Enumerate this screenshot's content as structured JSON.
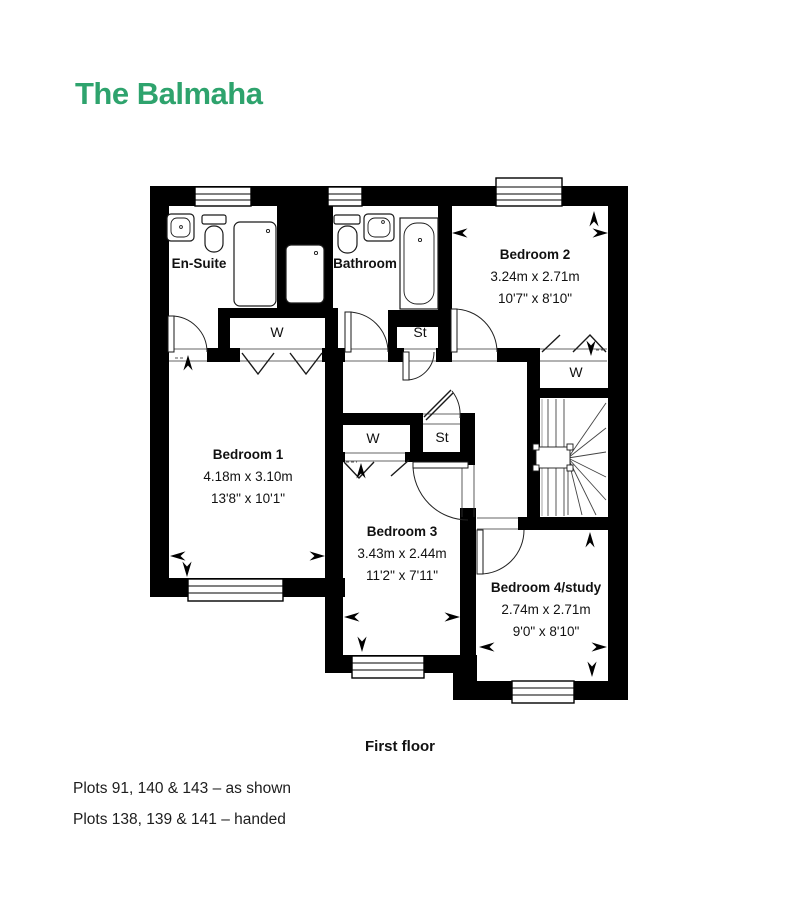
{
  "title": {
    "text": "The Balmaha",
    "color": "#2EA36D"
  },
  "floor_label": "First floor",
  "plots": {
    "line1": "Plots 91, 140 & 143 – as shown",
    "line2": "Plots 138, 139 & 141 – handed"
  },
  "rooms": {
    "ensuite": {
      "name": "En-Suite"
    },
    "bathroom": {
      "name": "Bathroom"
    },
    "bedroom1": {
      "name": "Bedroom 1",
      "metric": "4.18m x 3.10m",
      "imperial": "13'8\" x 10'1\""
    },
    "bedroom2": {
      "name": "Bedroom 2",
      "metric": "3.24m x 2.71m",
      "imperial": "10'7\" x 8'10\""
    },
    "bedroom3": {
      "name": "Bedroom 3",
      "metric": "3.43m x 2.44m",
      "imperial": "11'2\" x 7'11\""
    },
    "bedroom4": {
      "name": "Bedroom 4/study",
      "metric": "2.74m x 2.71m",
      "imperial": "9'0\" x 8'10\""
    }
  },
  "closets": {
    "wardrobe1": "W",
    "wardrobe2": "W",
    "wardrobe3": "W",
    "store1": "St",
    "store2": "St"
  },
  "plan_colors": {
    "wall": "#000000",
    "background": "#ffffff"
  }
}
